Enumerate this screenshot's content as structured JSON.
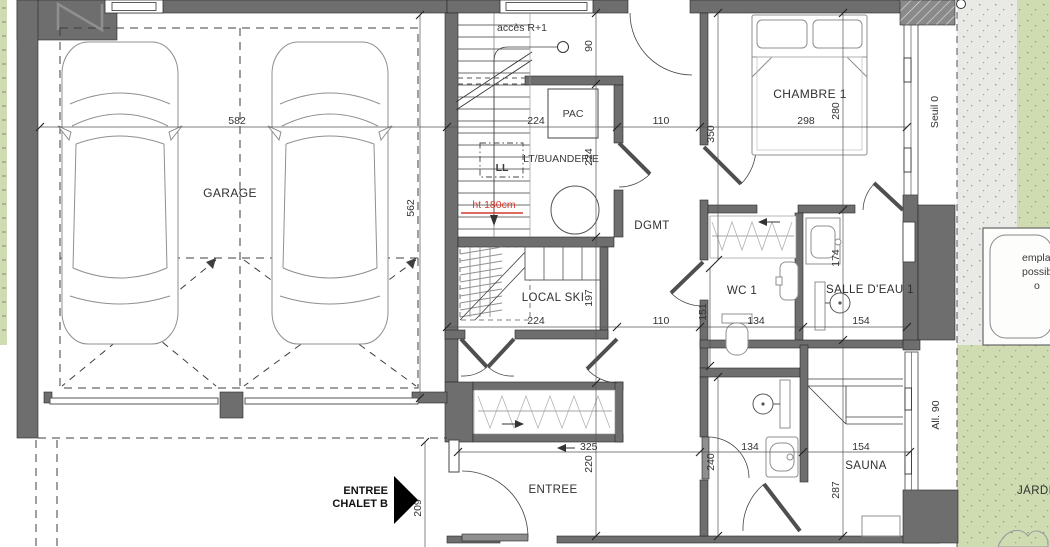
{
  "colors": {
    "wall": "#6e6e6e",
    "garden_green": "#cfdcb2",
    "paving_gray": "#e9e9e6",
    "red_annotation": "#d43a2e",
    "line": "#3c3c3c"
  },
  "rooms": {
    "garage": "GARAGE",
    "stairs_access": "accès R+1",
    "pac": "PAC",
    "laundry": "LT/BUANDERIE",
    "washer": "LL",
    "ski_room": "LOCAL SKI",
    "hallway": "DGMT",
    "bedroom1": "CHAMBRE 1",
    "wc1": "WC 1",
    "bathroom1": "SALLE D'EAU 1",
    "entrance": "ENTREE",
    "sauna": "SAUNA",
    "garden": "JARDIN"
  },
  "annotations": {
    "ceiling_height": "ht 180cm",
    "entrance_marker_line1": "ENTREE",
    "entrance_marker_line2": "CHALET B",
    "threshold": "Seuil 0",
    "sill": "All. 90",
    "spa_line1": "emplace",
    "spa_line2": "possible",
    "spa_line3": "o"
  },
  "dimensions": [
    {
      "id": "garage_width",
      "value": "582"
    },
    {
      "id": "laundry_zone_width",
      "value": "224"
    },
    {
      "id": "hall_width_top",
      "value": "110"
    },
    {
      "id": "bedroom_width",
      "value": "298"
    },
    {
      "id": "garage_depth",
      "value": "562"
    },
    {
      "id": "stair_top_depth",
      "value": "90"
    },
    {
      "id": "laundry_depth",
      "value": "224"
    },
    {
      "id": "ski_room_depth",
      "value": "197"
    },
    {
      "id": "ski_room_width",
      "value": "224"
    },
    {
      "id": "hall_width_mid",
      "value": "110"
    },
    {
      "id": "wc_width",
      "value": "134"
    },
    {
      "id": "bathroom_width",
      "value": "154"
    },
    {
      "id": "wc_depth",
      "value": "151"
    },
    {
      "id": "bathroom_depth",
      "value": "174"
    },
    {
      "id": "bedroom_depth",
      "value": "280"
    },
    {
      "id": "bedroom_hall_depth",
      "value": "350"
    },
    {
      "id": "entrance_width",
      "value": "325"
    },
    {
      "id": "shower_room_width",
      "value": "134"
    },
    {
      "id": "sauna_width",
      "value": "154"
    },
    {
      "id": "entrance_depth",
      "value": "220"
    },
    {
      "id": "shower_room_depth",
      "value": "240"
    },
    {
      "id": "sauna_depth",
      "value": "287"
    },
    {
      "id": "entrance_path_width",
      "value": "209"
    }
  ]
}
